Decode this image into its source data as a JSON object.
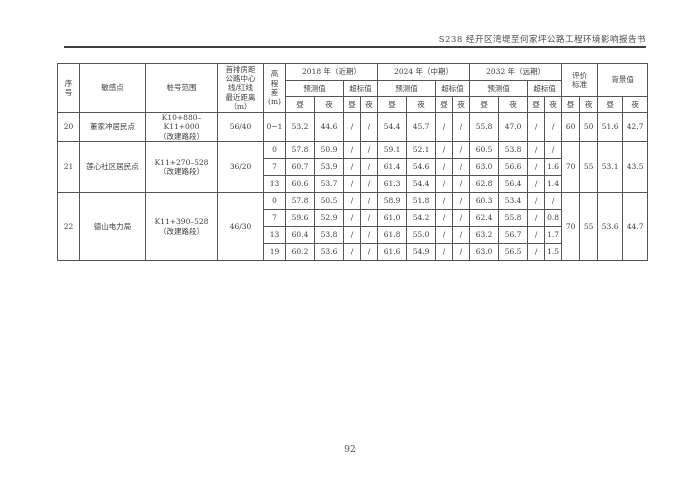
{
  "doc": {
    "header_title": "S238 经开区湾堤至何家坪公路工程环境影响报告书",
    "page_number": "92"
  },
  "table": {
    "head": {
      "seq": "序\n号",
      "point": "敏感点",
      "stake": "桩号范围",
      "distance": "首排房距\n公路中心\n线/红线\n最近距离\n（m）",
      "elev": "高\n程\n差\n(m)",
      "y2018": "2018 年（近期）",
      "y2024": "2024 年（中期）",
      "y2032": "2032 年（远期）",
      "pred": "预测值",
      "exceed": "超标值",
      "eval": "评价\n标准",
      "bg": "背景值",
      "day": "昼",
      "night": "夜"
    },
    "groups": [
      {
        "seq": "20",
        "point": "董家冲居民点",
        "stake": "K10+880–K11+000\n（改建路段）",
        "distance": "56/40",
        "eval_day": "60",
        "eval_night": "50",
        "bg_day": "51.6",
        "bg_night": "42.7",
        "subrows": [
          {
            "elev": "0~1",
            "v": [
              "53.2",
              "44.6",
              "/",
              "/",
              "54.4",
              "45.7",
              "/",
              "/",
              "55.8",
              "47.0",
              "/",
              "/"
            ]
          }
        ]
      },
      {
        "seq": "21",
        "point": "莲心社区居民点",
        "stake": "K11+270–528\n（改建路段）",
        "distance": "36/20",
        "eval_day": "70",
        "eval_night": "55",
        "bg_day": "53.1",
        "bg_night": "43.5",
        "subrows": [
          {
            "elev": "0",
            "v": [
              "57.8",
              "50.9",
              "/",
              "/",
              "59.1",
              "52.1",
              "/",
              "/",
              "60.5",
              "53.8",
              "/",
              "/"
            ]
          },
          {
            "elev": "7",
            "v": [
              "60.7",
              "53.9",
              "/",
              "/",
              "61.4",
              "54.6",
              "/",
              "/",
              "63.0",
              "56.6",
              "/",
              "1.6"
            ]
          },
          {
            "elev": "13",
            "v": [
              "60.6",
              "53.7",
              "/",
              "/",
              "61.3",
              "54.4",
              "/",
              "/",
              "62.8",
              "56.4",
              "/",
              "1.4"
            ]
          }
        ]
      },
      {
        "seq": "22",
        "point": "德山电力局",
        "stake": "K11+390–528\n（改建路段）",
        "distance": "46/30",
        "eval_day": "70",
        "eval_night": "55",
        "bg_day": "53.6",
        "bg_night": "44.7",
        "subrows": [
          {
            "elev": "0",
            "v": [
              "57.8",
              "50.5",
              "/",
              "/",
              "58.9",
              "51.8",
              "/",
              "/",
              "60.3",
              "53.4",
              "/",
              "/"
            ]
          },
          {
            "elev": "7",
            "v": [
              "59.6",
              "52.9",
              "/",
              "/",
              "61.0",
              "54.2",
              "/",
              "/",
              "62.4",
              "55.8",
              "/",
              "0.8"
            ]
          },
          {
            "elev": "13",
            "v": [
              "60.4",
              "53.8",
              "/",
              "/",
              "61.8",
              "55.0",
              "/",
              "/",
              "63.2",
              "56.7",
              "/",
              "1.7"
            ]
          },
          {
            "elev": "19",
            "v": [
              "60.2",
              "53.6",
              "/",
              "/",
              "61.6",
              "54.9",
              "/",
              "/",
              "63.0",
              "56.5",
              "/",
              "1.5"
            ]
          }
        ]
      }
    ]
  }
}
